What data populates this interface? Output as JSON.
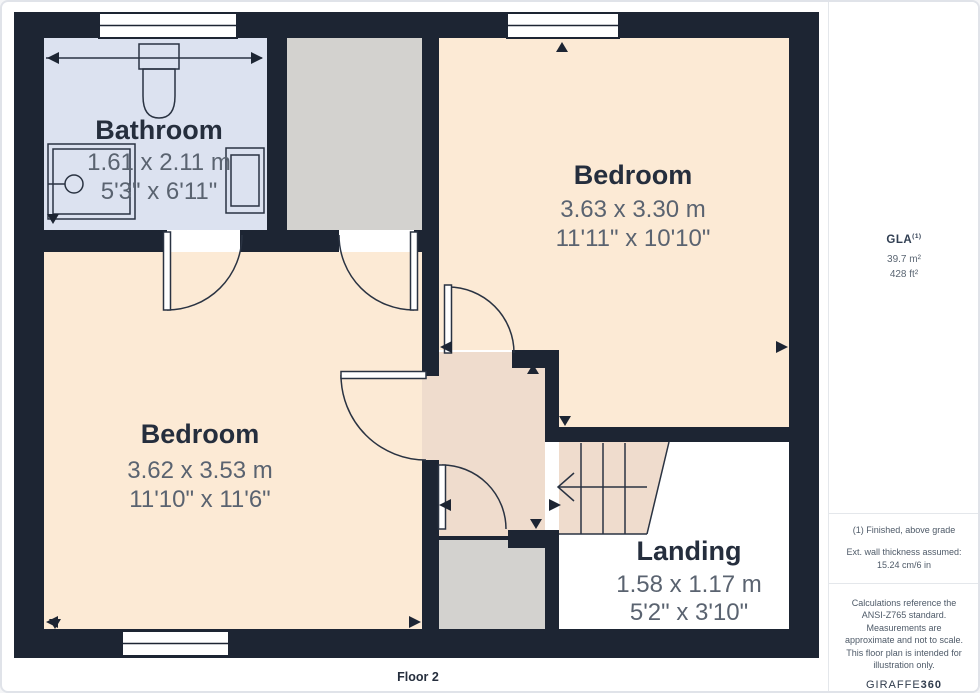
{
  "floorplan": {
    "floor_label": "Floor 2",
    "rooms": [
      {
        "name": "Bathroom",
        "metric": "1.61 x 2.11 m",
        "imperial": "5'3\" x 6'11\""
      },
      {
        "name": "Bedroom",
        "metric": "3.63 x 3.30 m",
        "imperial": "11'11\" x 10'10\""
      },
      {
        "name": "Bedroom",
        "metric": "3.62 x 3.53 m",
        "imperial": "11'10\" x 11'6\""
      },
      {
        "name": "Landing",
        "metric": "1.58 x 1.17 m",
        "imperial": "5'2\" x 3'10\""
      }
    ]
  },
  "sidebar": {
    "gla": {
      "label": "GLA",
      "sup": "(1)",
      "metric": "39.7 m²",
      "imperial": "428 ft²"
    },
    "notes": [
      "(1) Finished, above grade",
      "Ext. wall thickness assumed: 15.24 cm/6 in"
    ],
    "disclaimer": "Calculations reference the ANSI-Z765 standard. Measurements are approximate and not to scale. This floor plan is intended for illustration only.",
    "brand": {
      "regular": "GIRAFFE",
      "bold": "360"
    }
  },
  "colors": {
    "wall": "#1d2533",
    "line": "#2a3342",
    "bathroom": "#dce2f0",
    "bedroom": "#fcead5",
    "hallway": "#efdccd",
    "closet": "#d3d2cf",
    "void": "#ffffff",
    "title": "#252e3d",
    "dims": "#5a6370"
  }
}
